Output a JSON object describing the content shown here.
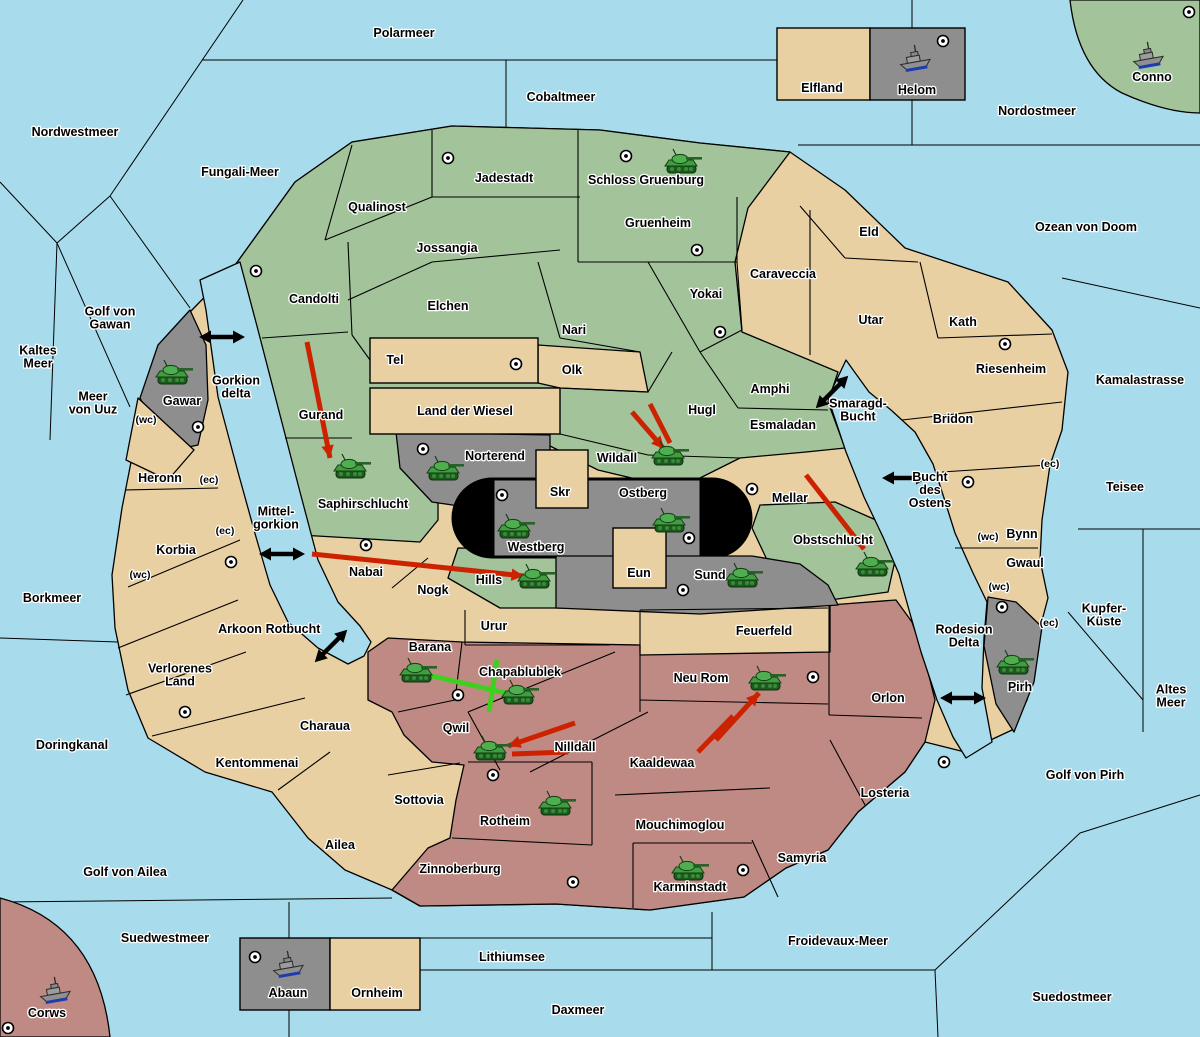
{
  "colors": {
    "sea": "#a8dcec",
    "land_tan": "#e9d0a2",
    "land_green": "#a3c49b",
    "land_grey": "#8e8e8e",
    "land_pink": "#c08a84",
    "border": "#000000",
    "black_zone": "#000000",
    "attack_arrow": "#cc2200",
    "move_line": "#3fd01f",
    "tank_body": "#3f9e3f",
    "ship_hull": "#909090",
    "ship_waterline": "#1e3cae",
    "label_outline": "#ffffff"
  },
  "sea_labels": [
    {
      "lines": [
        "Polarmeer"
      ],
      "x": 404,
      "y": 33
    },
    {
      "lines": [
        "Nordwestmeer"
      ],
      "x": 75,
      "y": 132
    },
    {
      "lines": [
        "Cobaltmeer"
      ],
      "x": 561,
      "y": 97
    },
    {
      "lines": [
        "Fungali-Meer"
      ],
      "x": 240,
      "y": 172
    },
    {
      "lines": [
        "Nordostmeer"
      ],
      "x": 1037,
      "y": 111
    },
    {
      "lines": [
        "Ozean von Doom"
      ],
      "x": 1086,
      "y": 227
    },
    {
      "lines": [
        "Kamalastrasse"
      ],
      "x": 1140,
      "y": 380
    },
    {
      "lines": [
        "Kaltes",
        "Meer"
      ],
      "x": 38,
      "y": 357
    },
    {
      "lines": [
        "Golf von",
        "Gawan"
      ],
      "x": 110,
      "y": 318
    },
    {
      "lines": [
        "Meer",
        "von Uuz"
      ],
      "x": 93,
      "y": 403
    },
    {
      "lines": [
        "Gorkion",
        "delta"
      ],
      "x": 236,
      "y": 387
    },
    {
      "lines": [
        "Mittel-",
        "gorkion"
      ],
      "x": 276,
      "y": 518
    },
    {
      "lines": [
        "Borkmeer"
      ],
      "x": 52,
      "y": 598
    },
    {
      "lines": [
        "Rotbucht"
      ],
      "x": 293,
      "y": 629
    },
    {
      "lines": [
        "Doringkanal"
      ],
      "x": 72,
      "y": 745
    },
    {
      "lines": [
        "Golf von Ailea"
      ],
      "x": 125,
      "y": 872
    },
    {
      "lines": [
        "Suedwestmeer"
      ],
      "x": 165,
      "y": 938
    },
    {
      "lines": [
        "Lithiumsee"
      ],
      "x": 512,
      "y": 957
    },
    {
      "lines": [
        "Daxmeer"
      ],
      "x": 578,
      "y": 1010
    },
    {
      "lines": [
        "Froidevaux-Meer"
      ],
      "x": 838,
      "y": 941
    },
    {
      "lines": [
        "Suedostmeer"
      ],
      "x": 1072,
      "y": 997
    },
    {
      "lines": [
        "Smaragd-",
        "Bucht"
      ],
      "x": 858,
      "y": 410
    },
    {
      "lines": [
        "Bucht",
        "des",
        "Ostens"
      ],
      "x": 930,
      "y": 490
    },
    {
      "lines": [
        "Rodesion",
        "Delta"
      ],
      "x": 964,
      "y": 636
    },
    {
      "lines": [
        "Teisee"
      ],
      "x": 1125,
      "y": 487
    },
    {
      "lines": [
        "Kupfer-",
        "Küste"
      ],
      "x": 1104,
      "y": 615
    },
    {
      "lines": [
        "Altes",
        "Meer"
      ],
      "x": 1171,
      "y": 696
    },
    {
      "lines": [
        "Golf von Pirh"
      ],
      "x": 1085,
      "y": 775
    }
  ],
  "territories": [
    {
      "name": "Jadestadt",
      "color": "green",
      "x": 504,
      "y": 178,
      "city": [
        448,
        158
      ]
    },
    {
      "name": "Schloss Gruenburg",
      "color": "green",
      "x": 646,
      "y": 180,
      "city": [
        626,
        156
      ],
      "tank": [
        683,
        163
      ]
    },
    {
      "name": "Qualinost",
      "color": "green",
      "x": 377,
      "y": 207
    },
    {
      "name": "Jossangia",
      "color": "green",
      "x": 447,
      "y": 248
    },
    {
      "name": "Gruenheim",
      "color": "green",
      "x": 658,
      "y": 223,
      "city": [
        697,
        250
      ]
    },
    {
      "name": "Candolti",
      "color": "green",
      "x": 314,
      "y": 299,
      "city": [
        256,
        271
      ]
    },
    {
      "name": "Elchen",
      "color": "green",
      "x": 448,
      "y": 306
    },
    {
      "name": "Nari",
      "color": "green",
      "x": 574,
      "y": 330
    },
    {
      "name": "Yokai",
      "color": "green",
      "x": 706,
      "y": 294,
      "city": [
        720,
        332
      ]
    },
    {
      "name": "Gurand",
      "color": "green",
      "x": 321,
      "y": 415
    },
    {
      "name": "Amphi",
      "color": "green",
      "x": 770,
      "y": 389
    },
    {
      "name": "Hugl",
      "color": "green",
      "x": 702,
      "y": 410
    },
    {
      "name": "Esmaladan",
      "color": "green",
      "x": 783,
      "y": 425
    },
    {
      "name": "Saphirschlucht",
      "color": "green",
      "x": 363,
      "y": 504,
      "tank": [
        352,
        468
      ]
    },
    {
      "name": "Wildall",
      "color": "green",
      "x": 617,
      "y": 458,
      "tank": [
        670,
        455
      ]
    },
    {
      "name": "Hills",
      "color": "green",
      "x": 489,
      "y": 580,
      "tank": [
        536,
        578
      ]
    },
    {
      "name": "Obstschlucht",
      "color": "green",
      "x": 833,
      "y": 540,
      "tank": [
        874,
        566
      ]
    },
    {
      "name": "Conno",
      "color": "green",
      "x": 1152,
      "y": 77,
      "ship": [
        1148,
        57
      ],
      "city": [
        1189,
        12
      ]
    },
    {
      "name": "Elfland",
      "color": "tan",
      "x": 822,
      "y": 88
    },
    {
      "name": "Eld",
      "color": "tan",
      "x": 869,
      "y": 232
    },
    {
      "name": "Caraveccia",
      "color": "tan",
      "x": 783,
      "y": 274
    },
    {
      "name": "Utar",
      "color": "tan",
      "x": 871,
      "y": 320
    },
    {
      "name": "Kath",
      "color": "tan",
      "x": 963,
      "y": 322,
      "city": [
        1005,
        344
      ]
    },
    {
      "name": "Riesenheim",
      "color": "tan",
      "x": 1011,
      "y": 369
    },
    {
      "name": "Bridon",
      "color": "tan",
      "x": 953,
      "y": 419,
      "city": [
        968,
        482
      ]
    },
    {
      "name": "Tel",
      "color": "tan",
      "x": 395,
      "y": 360,
      "city": [
        516,
        364
      ]
    },
    {
      "name": "Olk",
      "color": "tan",
      "x": 572,
      "y": 370
    },
    {
      "name": "Land der Wiesel",
      "color": "tan",
      "x": 465,
      "y": 411
    },
    {
      "name": "Mellar",
      "color": "tan",
      "x": 790,
      "y": 498,
      "city": [
        752,
        489
      ]
    },
    {
      "name": "Skr",
      "color": "tan",
      "x": 560,
      "y": 492
    },
    {
      "name": "Eun",
      "color": "tan",
      "x": 639,
      "y": 573
    },
    {
      "name": "Urur",
      "color": "tan",
      "x": 494,
      "y": 626
    },
    {
      "name": "Feuerfeld",
      "color": "tan",
      "x": 764,
      "y": 631
    },
    {
      "name": "Nabai",
      "color": "tan",
      "x": 366,
      "y": 572,
      "city": [
        366,
        545
      ]
    },
    {
      "name": "Nogk",
      "color": "tan",
      "x": 433,
      "y": 590
    },
    {
      "name": "Heronn",
      "color": "tan",
      "x": 160,
      "y": 478
    },
    {
      "name": "Korbia",
      "color": "tan",
      "x": 176,
      "y": 550,
      "city": [
        231,
        562
      ]
    },
    {
      "name": "Arkoon",
      "color": "tan",
      "x": 240,
      "y": 629
    },
    {
      "name": "Verlorenes Land",
      "lines": [
        "Verlorenes",
        "Land"
      ],
      "color": "tan",
      "x": 180,
      "y": 675
    },
    {
      "name": "Charaua",
      "color": "tan",
      "x": 325,
      "y": 726,
      "city": [
        185,
        712
      ]
    },
    {
      "name": "Kentommenai",
      "color": "tan",
      "x": 257,
      "y": 763
    },
    {
      "name": "Ailea",
      "color": "tan",
      "x": 340,
      "y": 845
    },
    {
      "name": "Sottovia",
      "color": "tan",
      "x": 419,
      "y": 800
    },
    {
      "name": "Ornheim",
      "color": "tan",
      "x": 377,
      "y": 993
    },
    {
      "name": "Bynn",
      "color": "tan",
      "x": 1022,
      "y": 534
    },
    {
      "name": "Gwaul",
      "color": "tan",
      "x": 1025,
      "y": 563
    },
    {
      "name": "Helom",
      "color": "grey",
      "x": 917,
      "y": 90,
      "ship": [
        915,
        60
      ],
      "city": [
        943,
        41
      ]
    },
    {
      "name": "Gawar",
      "color": "grey",
      "x": 182,
      "y": 401,
      "tank": [
        174,
        374
      ],
      "city": [
        198,
        427
      ]
    },
    {
      "name": "Norterend",
      "color": "grey",
      "x": 495,
      "y": 456,
      "tank": [
        445,
        470
      ],
      "city": [
        423,
        449
      ]
    },
    {
      "name": "Westberg",
      "color": "grey",
      "x": 536,
      "y": 547,
      "tank": [
        516,
        528
      ],
      "city": [
        502,
        495
      ]
    },
    {
      "name": "Ostberg",
      "color": "grey",
      "x": 643,
      "y": 493,
      "tank": [
        671,
        522
      ],
      "city": [
        689,
        538
      ]
    },
    {
      "name": "Sund",
      "color": "grey",
      "x": 710,
      "y": 575,
      "tank": [
        744,
        577
      ],
      "city": [
        683,
        590
      ]
    },
    {
      "name": "Pirh",
      "color": "grey",
      "x": 1020,
      "y": 687,
      "tank": [
        1015,
        664
      ],
      "city": [
        1002,
        607
      ]
    },
    {
      "name": "Abaun",
      "color": "grey",
      "x": 288,
      "y": 993,
      "ship": [
        288,
        966
      ],
      "city": [
        255,
        957
      ]
    },
    {
      "name": "Barana",
      "color": "pink",
      "x": 430,
      "y": 647,
      "tank": [
        418,
        672
      ]
    },
    {
      "name": "Chapablublek",
      "color": "pink",
      "x": 520,
      "y": 672,
      "tank": [
        520,
        694
      ]
    },
    {
      "name": "Qwil",
      "color": "pink",
      "x": 456,
      "y": 728,
      "tank": [
        492,
        750
      ],
      "city": [
        458,
        695
      ]
    },
    {
      "name": "Nilldall",
      "color": "pink",
      "x": 575,
      "y": 747
    },
    {
      "name": "Kaaldewaa",
      "color": "pink",
      "x": 662,
      "y": 763
    },
    {
      "name": "Neu Rom",
      "color": "pink",
      "x": 701,
      "y": 678,
      "tank": [
        767,
        680
      ],
      "city": [
        813,
        677
      ]
    },
    {
      "name": "Orlon",
      "color": "pink",
      "x": 888,
      "y": 698,
      "city": [
        944,
        762
      ]
    },
    {
      "name": "Zinnoberburg",
      "color": "pink",
      "x": 460,
      "y": 869,
      "city": [
        573,
        882
      ]
    },
    {
      "name": "Rotheim",
      "color": "pink",
      "x": 505,
      "y": 821,
      "tank": [
        557,
        805
      ],
      "city": [
        493,
        775
      ]
    },
    {
      "name": "Mouchimoglou",
      "color": "pink",
      "x": 680,
      "y": 825
    },
    {
      "name": "Karminstadt",
      "color": "pink",
      "x": 690,
      "y": 887,
      "tank": [
        690,
        870
      ],
      "city": [
        743,
        870
      ]
    },
    {
      "name": "Samyria",
      "color": "pink",
      "x": 802,
      "y": 858
    },
    {
      "name": "Losteria",
      "color": "pink",
      "x": 885,
      "y": 793
    },
    {
      "name": "Corws",
      "color": "pink",
      "x": 47,
      "y": 1013,
      "ship": [
        55,
        992
      ],
      "city": [
        8,
        1028
      ]
    }
  ],
  "coast_markers": [
    {
      "t": "(wc)",
      "x": 146,
      "y": 419
    },
    {
      "t": "(ec)",
      "x": 209,
      "y": 479
    },
    {
      "t": "(ec)",
      "x": 225,
      "y": 530
    },
    {
      "t": "(wc)",
      "x": 140,
      "y": 574
    },
    {
      "t": "(wc)",
      "x": 988,
      "y": 536
    },
    {
      "t": "(wc)",
      "x": 999,
      "y": 586
    },
    {
      "t": "(ec)",
      "x": 1049,
      "y": 622
    },
    {
      "t": "(ec)",
      "x": 1050,
      "y": 463
    }
  ],
  "link_arrows": [
    {
      "x": 222,
      "y": 337,
      "a": 0
    },
    {
      "x": 282,
      "y": 554,
      "a": 0
    },
    {
      "x": 905,
      "y": 478,
      "a": 0
    },
    {
      "x": 963,
      "y": 698,
      "a": 0
    },
    {
      "x": 832,
      "y": 392,
      "a": -45
    },
    {
      "x": 331,
      "y": 646,
      "a": -45
    }
  ],
  "attack_arrows": [
    {
      "x1": 307,
      "y1": 342,
      "x2": 330,
      "y2": 458,
      "head": true
    },
    {
      "x1": 632,
      "y1": 412,
      "x2": 664,
      "y2": 449,
      "head": true
    },
    {
      "x1": 650,
      "y1": 404,
      "x2": 670,
      "y2": 443,
      "head": false
    },
    {
      "x1": 806,
      "y1": 475,
      "x2": 864,
      "y2": 549,
      "head": true
    },
    {
      "x1": 312,
      "y1": 554,
      "x2": 524,
      "y2": 576,
      "head": true
    },
    {
      "x1": 575,
      "y1": 723,
      "x2": 508,
      "y2": 746,
      "head": true
    },
    {
      "x1": 568,
      "y1": 752,
      "x2": 512,
      "y2": 754,
      "head": false
    },
    {
      "x1": 716,
      "y1": 740,
      "x2": 759,
      "y2": 693,
      "head": true
    },
    {
      "x1": 698,
      "y1": 752,
      "x2": 733,
      "y2": 716,
      "head": false
    }
  ],
  "move_lines": [
    {
      "x1": 432,
      "y1": 676,
      "x2": 506,
      "y2": 693
    },
    {
      "x1": 497,
      "y1": 660,
      "x2": 489,
      "y2": 712
    }
  ]
}
